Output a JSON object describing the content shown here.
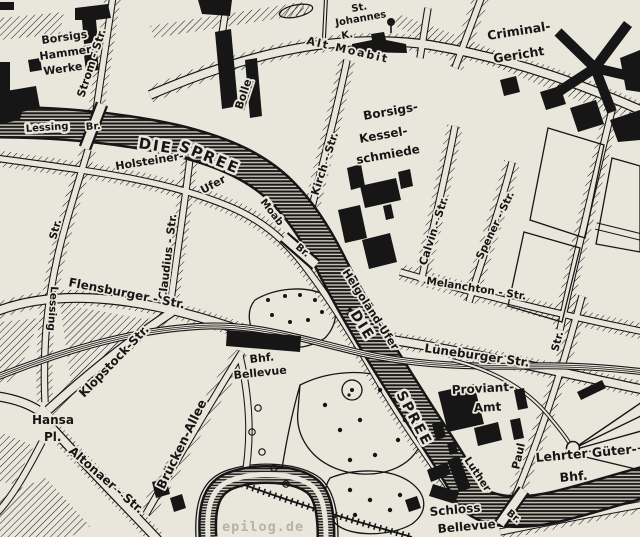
{
  "map": {
    "watermark": "epilog.de",
    "colors": {
      "paper": "#e9e6dc",
      "ink": "#161616",
      "watermark": "#b7b2a6"
    },
    "places": {
      "borsig_hammerwerke": [
        "Borsigs",
        "Hammer-",
        "Werke"
      ],
      "st_johannes": [
        "St.",
        "Johannes",
        "K."
      ],
      "criminal_gericht": [
        "Criminal-",
        "Gericht"
      ],
      "bolle": "Bolle",
      "borsig_kesselschmiede": [
        "Borsigs-",
        "Kessel-",
        "schmiede"
      ],
      "bhf_bellevue": [
        "Bhf.",
        "Bellevue"
      ],
      "proviant_amt": [
        "Proviant-",
        "Amt"
      ],
      "lehrter_gueterbahnhof": [
        "Lehrter Güter-",
        "Bhf."
      ],
      "schloss_bellevue": [
        "Schloss",
        "Bellevue"
      ],
      "hansa_platz": [
        "Hansa",
        "Pl."
      ]
    },
    "streets": {
      "strom_str": "Strom - Str.",
      "alt_moabit": "Alt  Moabit",
      "kirch_str": "Kirch - Str.",
      "calvin_str": "Calvin - Str.",
      "spener_str": "Spener - Str.",
      "melanchton_str": "Melanchton - Str.",
      "claudius_str": "Claudius - Str.",
      "holsteiner_ufer": [
        "Holsteiner-",
        "Ufer"
      ],
      "flensburger_str": "Flensburger - Str.",
      "lessing_str": [
        "Lessing",
        "Str."
      ],
      "klopstock_str": "Klopstock-Str.",
      "altonaer_str": "Altonaer - Str.",
      "bruecken_allee": "Brücken-Allee",
      "helgolaend_ufer": "Helgoländ-Ufer",
      "lueneburger_str": "Lüneburger Str.",
      "paul_str": [
        "Paul",
        "Str."
      ]
    },
    "water": {
      "spree_upper": [
        "DIE",
        "SPREE"
      ],
      "spree_lower": [
        "DIE",
        "SPREE"
      ]
    },
    "bridges": {
      "lessing_bruecke": [
        "Lessing",
        "Br."
      ],
      "moabiter_bruecke": [
        "Moab",
        "Br."
      ],
      "luther_bruecke": [
        "Luther",
        "Br."
      ]
    }
  }
}
